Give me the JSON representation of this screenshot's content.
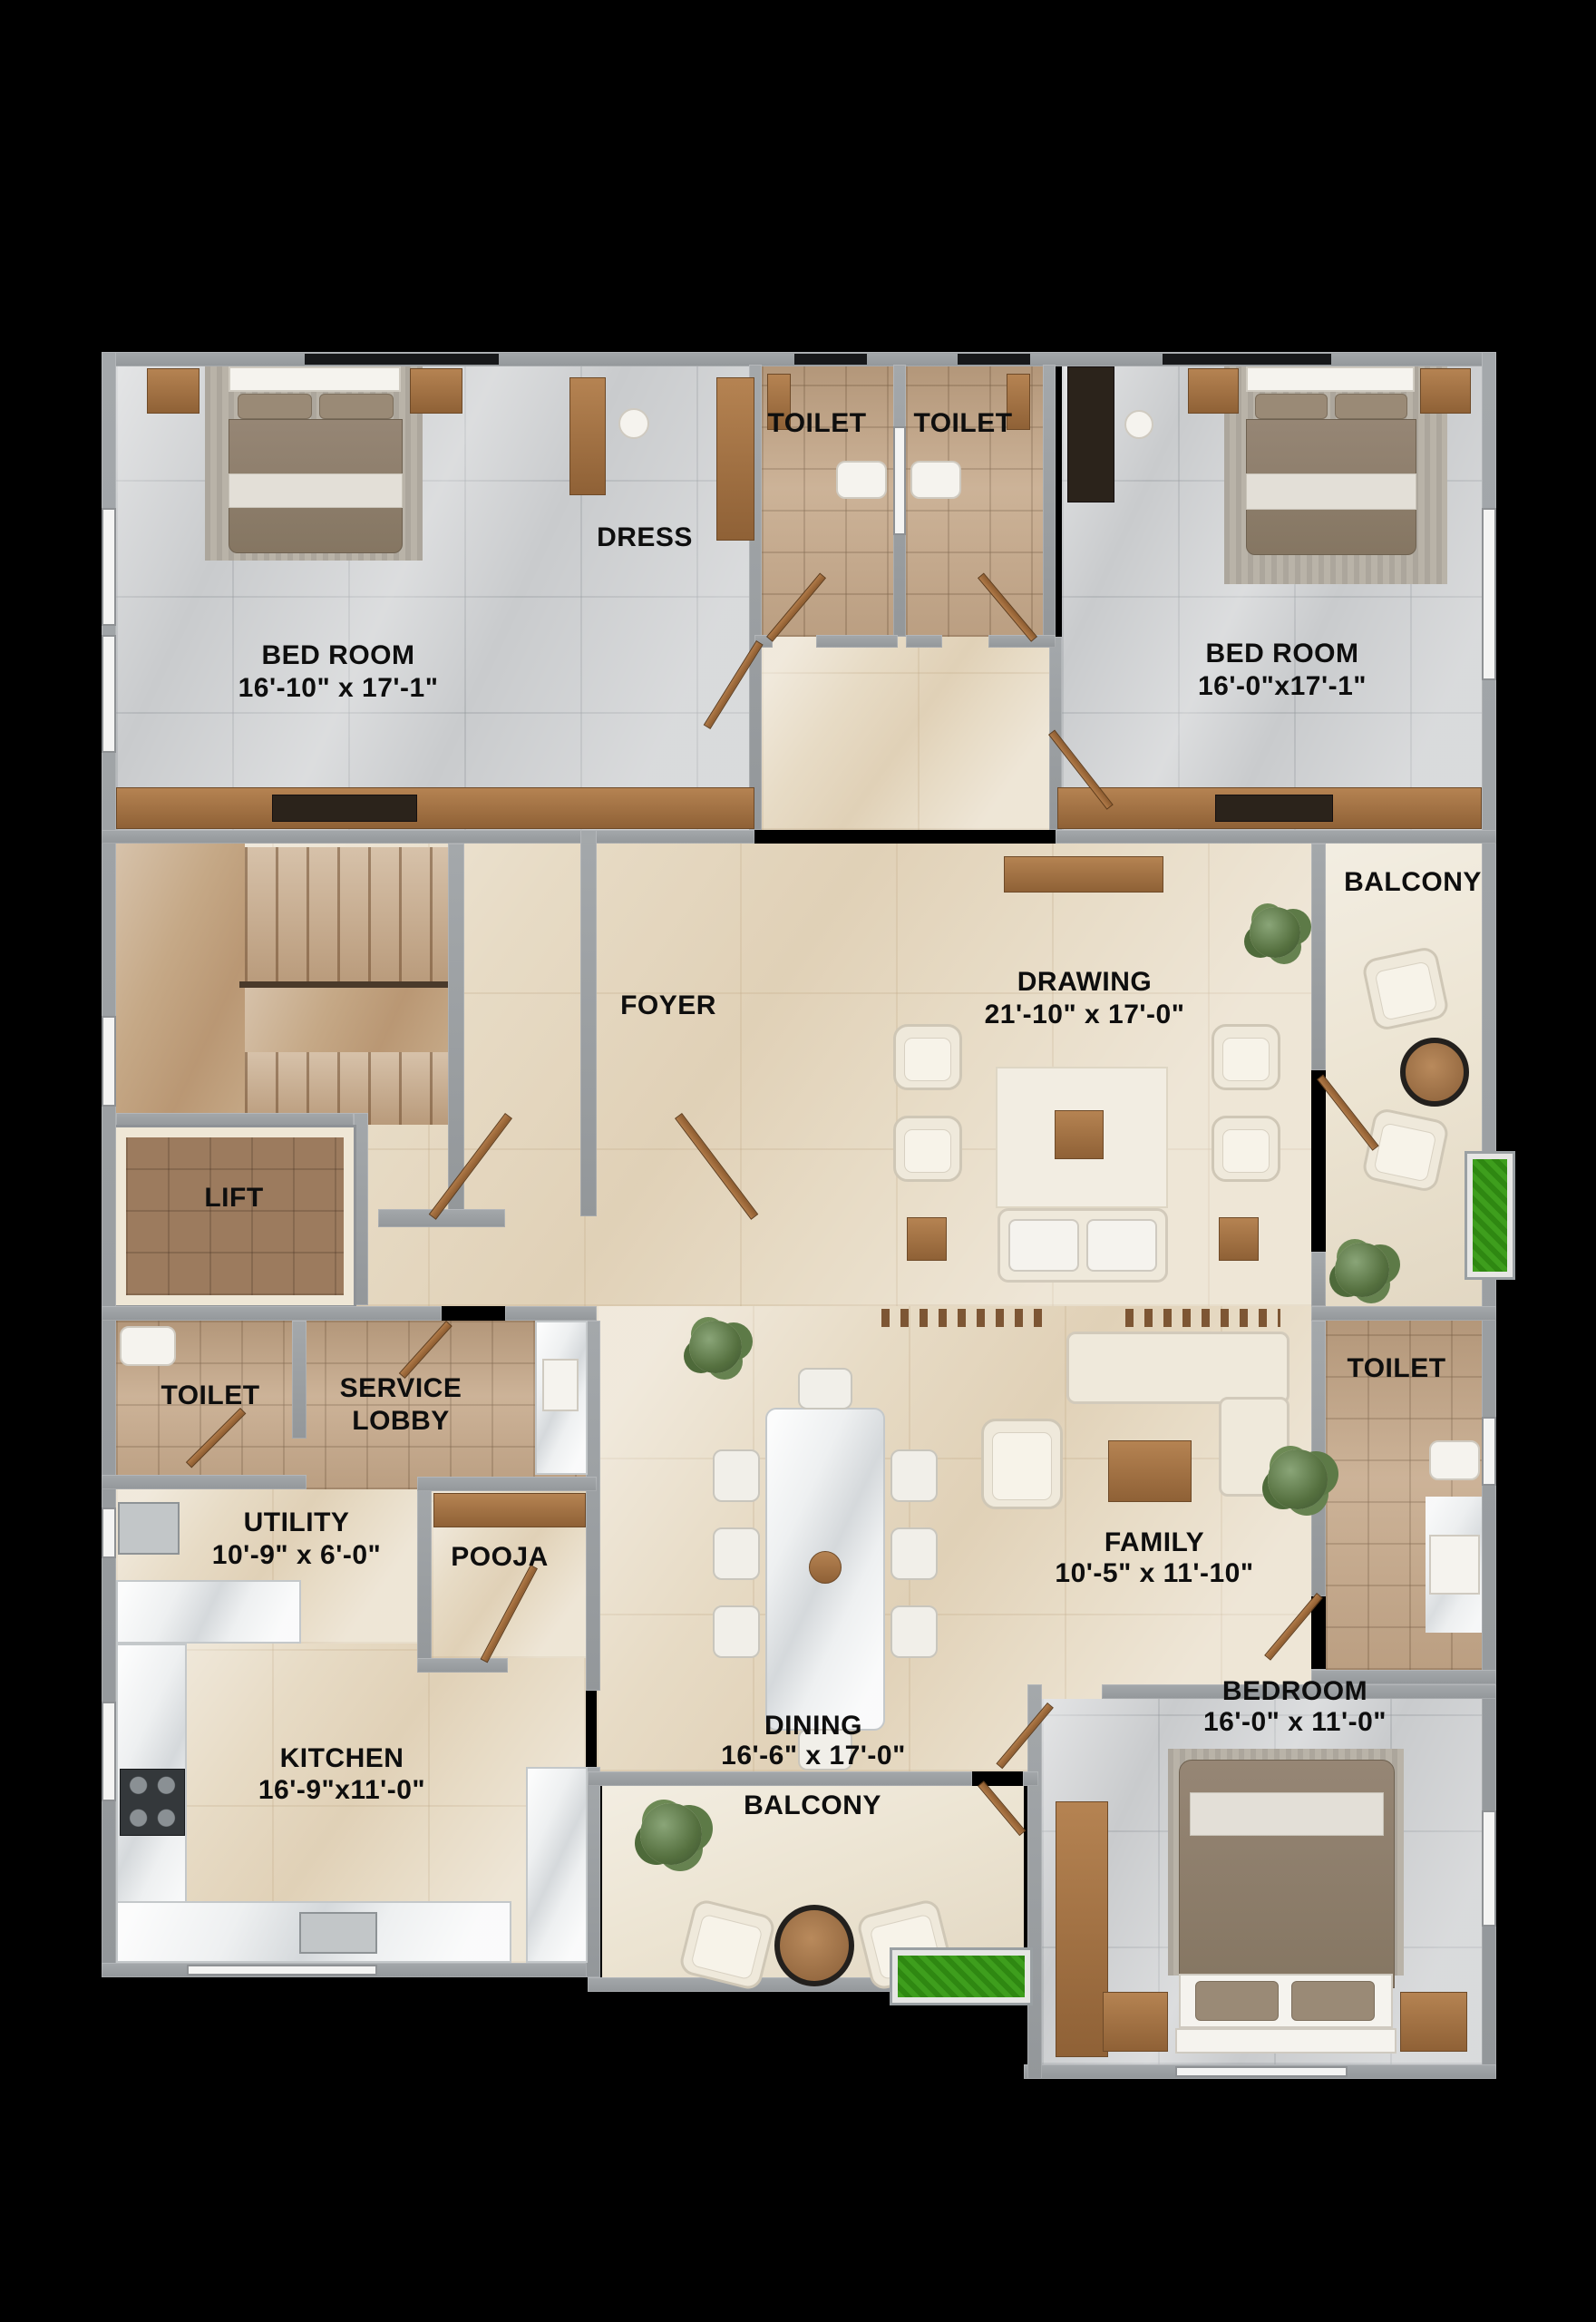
{
  "palette": {
    "background": "#000000",
    "wall": "#989c9f",
    "floor_gray_marble": "#c9cbcd",
    "floor_tan_tile": "#c4a88b",
    "floor_beige_marble": "#e7dbc5",
    "floor_balcony": "#ece4d2",
    "wood": "#a97a4e",
    "lift_floor": "#9c7b5e",
    "planter_green": "#3e9e1d",
    "label_color": "#0e0e0e"
  },
  "rooms": {
    "bedroom_tl": {
      "label": "BED ROOM",
      "dims": "16'-10\" x 17'-1\""
    },
    "dress": {
      "label": "DRESS"
    },
    "toilet_top_1": {
      "label": "TOILET"
    },
    "toilet_top_2": {
      "label": "TOILET"
    },
    "bedroom_tr": {
      "label": "BED ROOM",
      "dims": "16'-0\"x17'-1\""
    },
    "balcony_right": {
      "label": "BALCONY"
    },
    "foyer": {
      "label": "FOYER"
    },
    "drawing": {
      "label": "DRAWING",
      "dims": "21'-10\" x 17'-0\""
    },
    "lift": {
      "label": "LIFT"
    },
    "toilet_left": {
      "label": "TOILET"
    },
    "service_lobby": {
      "label_line1": "SERVICE",
      "label_line2": "LOBBY"
    },
    "utility": {
      "label": "UTILITY",
      "dims": "10'-9\" x 6'-0\""
    },
    "pooja": {
      "label": "POOJA"
    },
    "toilet_right": {
      "label": "TOILET"
    },
    "family": {
      "label": "FAMILY",
      "dims": "10'-5\" x 11'-10\""
    },
    "dining": {
      "label": "DINING",
      "dims": "16'-6\" x 17'-0\""
    },
    "kitchen": {
      "label": "KITCHEN",
      "dims": "16'-9\"x11'-0\""
    },
    "balcony_bottom": {
      "label": "BALCONY"
    },
    "bedroom_br": {
      "label": "BEDROOM",
      "dims": "16'-0\" x 11'-0\""
    }
  }
}
